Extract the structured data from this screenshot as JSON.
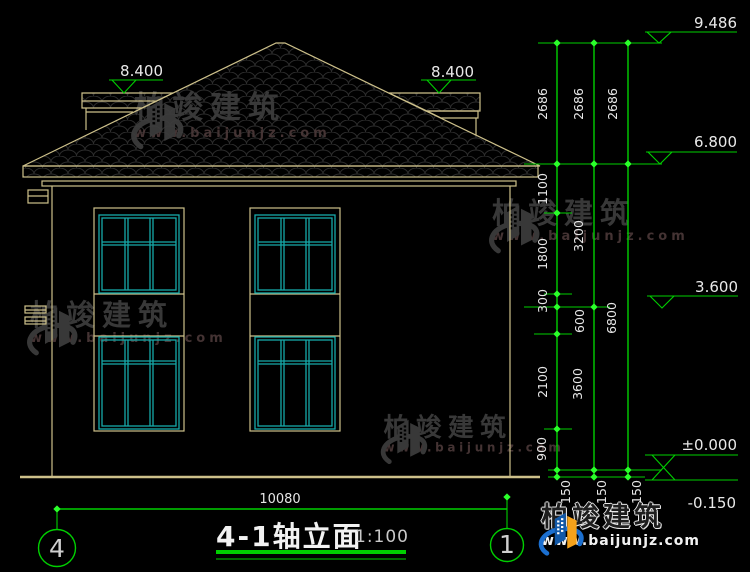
{
  "title": {
    "name": "4-1轴立面",
    "scale": "1:100"
  },
  "elevations": {
    "ridge": "9.486",
    "canopy_left": "8.400",
    "canopy_right": "8.400",
    "eave": "6.800",
    "floor2": "3.600",
    "floor1": "±0.000",
    "grade": "-0.150"
  },
  "dim_chains": {
    "inner": [
      "2686",
      "1100",
      "1800",
      "300",
      "600",
      "2100",
      "900",
      "150"
    ],
    "middle": [
      "2686",
      "3200",
      "3600",
      "150"
    ],
    "outer": [
      "2686",
      "6800",
      "150"
    ]
  },
  "bottom_dim": "10080",
  "axes": {
    "left": "4",
    "right": "1"
  },
  "watermark": {
    "brand": "柏竣建筑",
    "url": "www.baijunjz.com"
  },
  "footer": {
    "brand": "柏竣建筑",
    "url": "www.baijunjz.com"
  },
  "colors": {
    "background": "#000000",
    "cad_line_tan": "#cdc08a",
    "dimension_green": "#00cf00",
    "window_teal": "#17a9a9",
    "dim_text_white": "#e9e9e9",
    "watermark_gray": "#3d3d3d",
    "logo_blue": "#1565c0",
    "logo_orange": "#f5a21b"
  }
}
